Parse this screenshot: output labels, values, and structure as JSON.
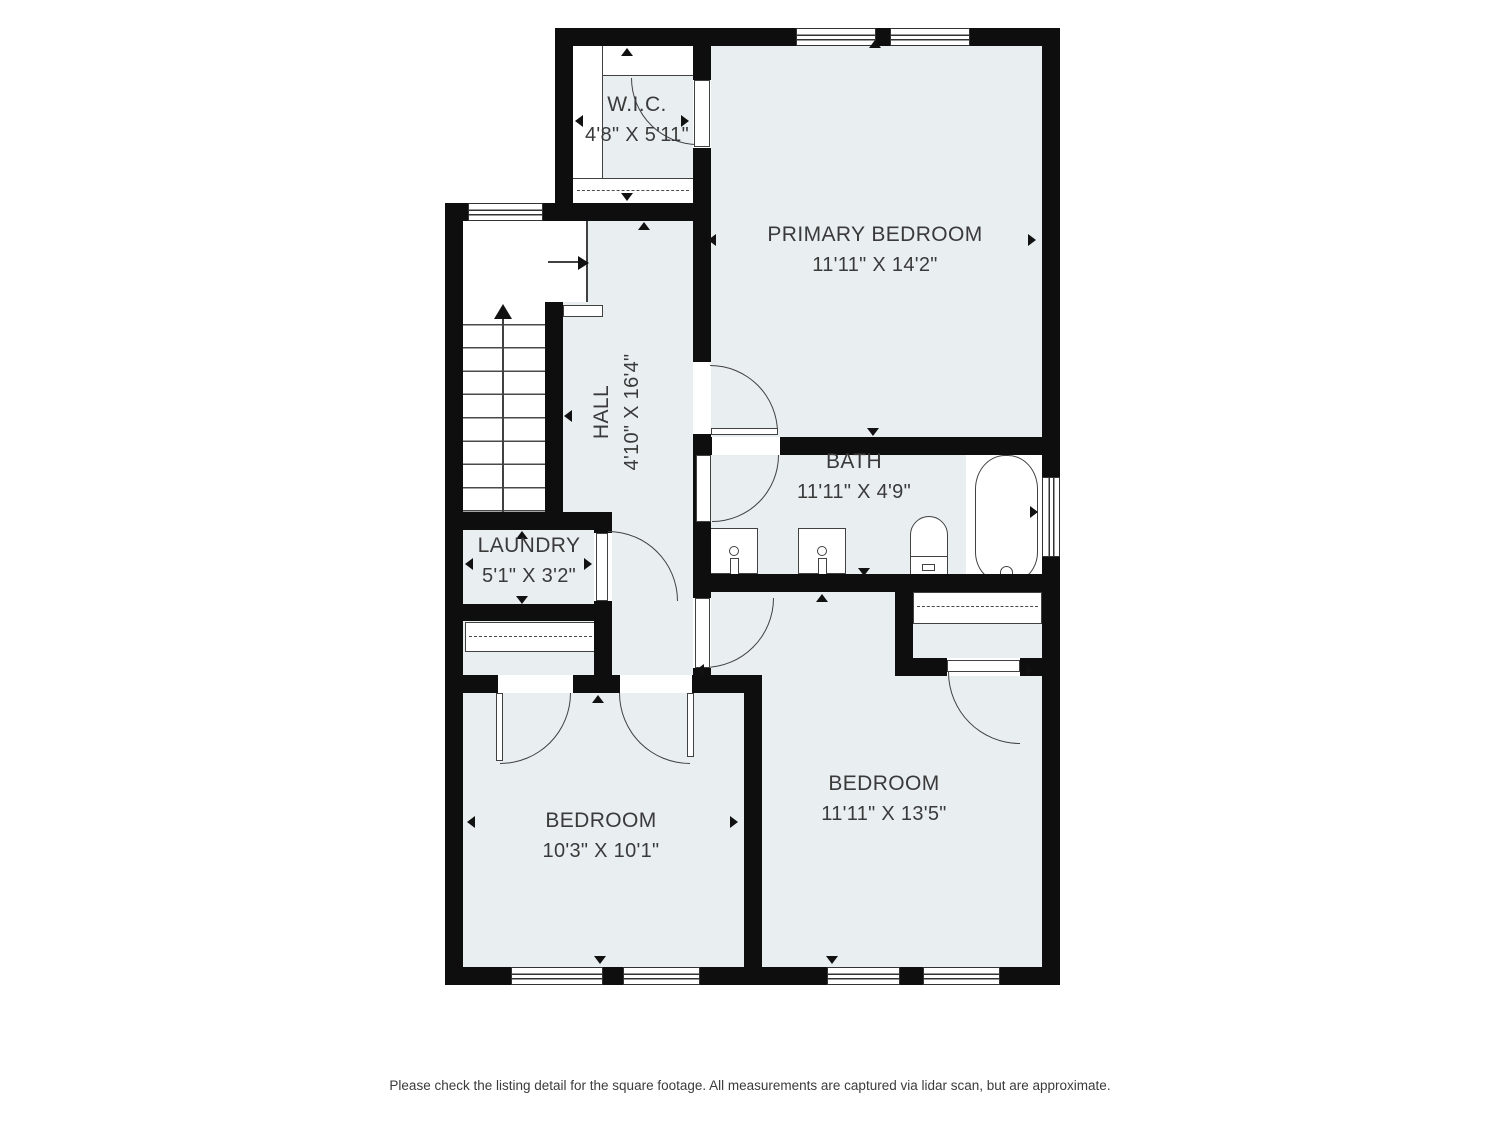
{
  "plan": {
    "rooms": {
      "wic": {
        "name": "W.I.C.",
        "dims": "4'8\" X 5'11\""
      },
      "primary_bedroom": {
        "name": "PRIMARY BEDROOM",
        "dims": "11'11\" X 14'2\""
      },
      "hall": {
        "name": "HALL",
        "dims": "4'10\" X 16'4\""
      },
      "bath": {
        "name": "BATH",
        "dims": "11'11\" X 4'9\""
      },
      "laundry": {
        "name": "LAUNDRY",
        "dims": "5'1\" X 3'2\""
      },
      "bedroom_left": {
        "name": "BEDROOM",
        "dims": "10'3\" X 10'1\""
      },
      "bedroom_right": {
        "name": "BEDROOM",
        "dims": "11'11\" X 13'5\""
      }
    },
    "colors": {
      "floor": "#e9eef1",
      "wall": "#0e0e0e",
      "line": "#414141",
      "text": "#3a3a3a"
    }
  },
  "footer": {
    "disclaimer": "Please check the listing detail for the square footage. All measurements are captured via lidar scan, but are approximate."
  }
}
